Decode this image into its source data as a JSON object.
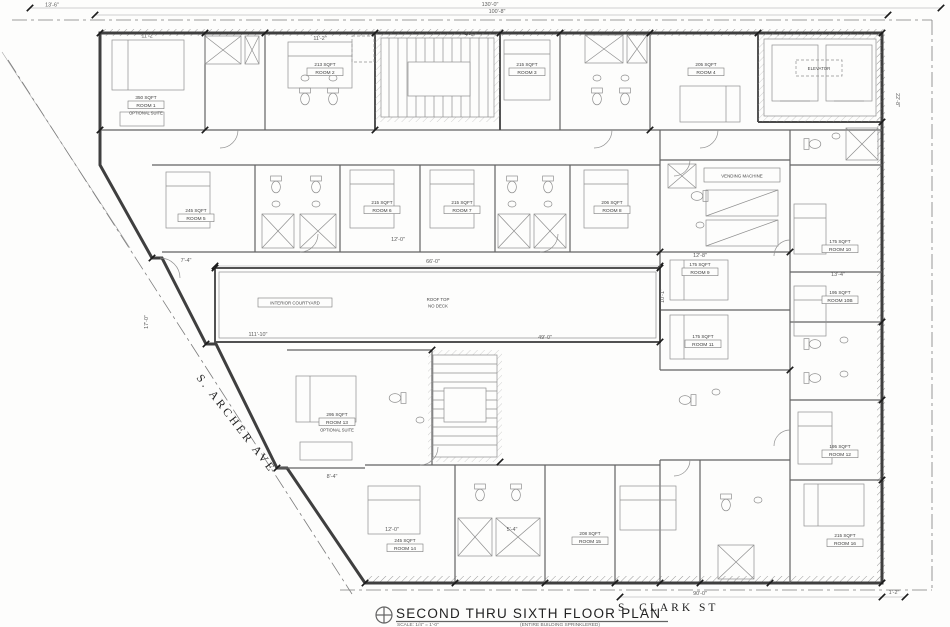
{
  "title_block": {
    "title": "SECOND THRU SIXTH FLOOR PLAN",
    "scale": "SCALE: 1/4\" = 1'-0\"",
    "note": "(ENTIRE BUILDING SPRINKLERED)"
  },
  "streets": {
    "archer": "S. ARCHER AVE",
    "clark": "S. CLARK ST"
  },
  "courtyard": {
    "label": "INTERIOR COURTYARD",
    "roof_line1": "ROOF TOP",
    "roof_line2": "NO DECK"
  },
  "labels": {
    "elevator": "ELEVATOR",
    "vending": "VENDING MACHINE"
  },
  "rooms": [
    {
      "sqft": "350 SQFT",
      "name": "ROOM 1",
      "note": "OPTIONAL SUITE"
    },
    {
      "sqft": "213 SQFT",
      "name": "ROOM 2"
    },
    {
      "sqft": "215 SQFT",
      "name": "ROOM 3"
    },
    {
      "sqft": "205 SQFT",
      "name": "ROOM 4"
    },
    {
      "sqft": "245 SQFT",
      "name": "ROOM 5"
    },
    {
      "sqft": "215 SQFT",
      "name": "ROOM 6"
    },
    {
      "sqft": "215 SQFT",
      "name": "ROOM 7"
    },
    {
      "sqft": "206 SQFT",
      "name": "ROOM 8"
    },
    {
      "sqft": "175 SQFT",
      "name": "ROOM 9"
    },
    {
      "sqft": "175 SQFT",
      "name": "ROOM 10"
    },
    {
      "sqft": "195 SQFT",
      "name": "ROOM 10B"
    },
    {
      "sqft": "175 SQFT",
      "name": "ROOM 11"
    },
    {
      "sqft": "195 SQFT",
      "name": "ROOM 12"
    },
    {
      "sqft": "295 SQFT",
      "name": "ROOM 13",
      "note": "OPTIONAL SUITE"
    },
    {
      "sqft": "245 SQFT",
      "name": "ROOM 14"
    },
    {
      "sqft": "208 SQFT",
      "name": "ROOM 15"
    },
    {
      "sqft": "215 SQFT",
      "name": "ROOM 16"
    }
  ],
  "dimensions": {
    "overall_top": "130'-0\"",
    "top_inner": "100'-8\"",
    "top_left": "13'-6\"",
    "courtyard_w": "66'-0\"",
    "courtyard_lower": "49'-0\"",
    "courtyard_left": "111'-10\"",
    "left_v": "17'-0\"",
    "bottom": "90'-0\"",
    "bottom_right": "1'-2\"",
    "bed_a": "11'-2\"",
    "bed_b": "11'-2\"",
    "stair_top": "4'-6\"",
    "row2_w": "12'-0\"",
    "row2_l": "7'-4\"",
    "rc_w": "12'-8\"",
    "rc_h": "10'-1\"",
    "right_w": "13'-4\"",
    "right_v": "22'-8\"",
    "suite_w": "8'-4\"",
    "bot_a": "12'-0\"",
    "bot_b": "5'-4\""
  }
}
